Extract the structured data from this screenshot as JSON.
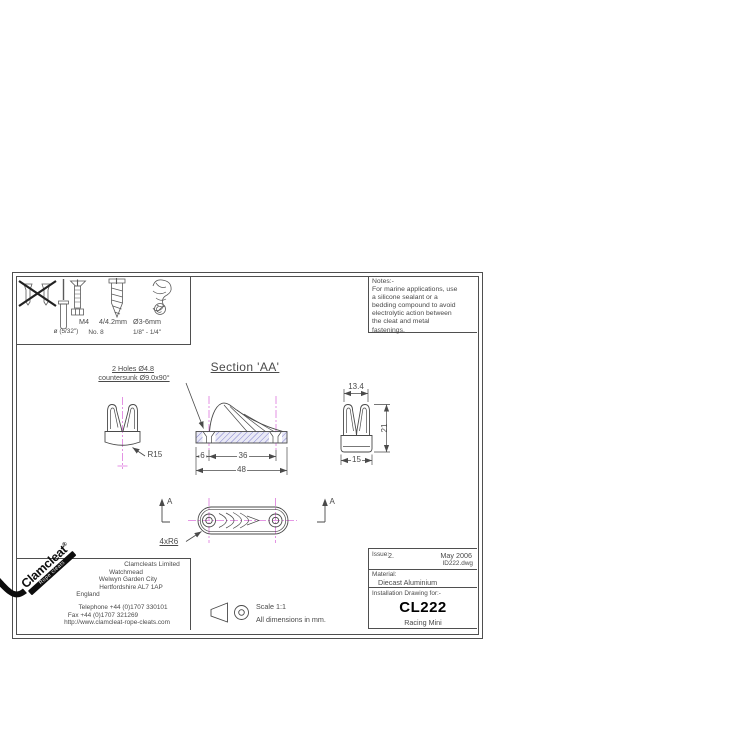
{
  "colors": {
    "line": "#4a4a4a",
    "centerline": "#dd77dd",
    "hatch_line": "#8080cc",
    "hatch_bg": "#e9e9f6",
    "logo_black": "#0d0d0d"
  },
  "sheet": {
    "fasteners": {
      "row1": {
        "m4": "M4",
        "wood_metric": "4/4.2mm",
        "rope_metric": "Ø3-6mm"
      },
      "row2": {
        "rivet_size": "ø (5/32\")",
        "wood_gauge": "No. 8",
        "rope_imperial": "1/8\" - 1/4\""
      }
    },
    "notes": {
      "title": "Notes:-",
      "lines": [
        "For marine applications, use",
        "a silicone sealant or a",
        "bedding compound to avoid",
        "electrolytic action between",
        "the cleat and metal",
        "fastenings."
      ]
    },
    "annotations": {
      "holes_line1": "2 Holes Ø4.8",
      "holes_line2": "countersunk Ø9.0x90°",
      "section_title": "Section 'AA'",
      "radius": "R15",
      "dim_6": "6",
      "dim_36": "36",
      "dim_48": "48",
      "dim_13_4": "13.4",
      "dim_21": "21",
      "dim_15": "15",
      "ribs": "4xR6",
      "section_letter": "A"
    }
  },
  "company": {
    "logo_name": "Clamcleat",
    "logo_reg": "®",
    "logo_tag": "Rope cleats",
    "name": "Clamcleats Limited",
    "address": [
      "Watchmead",
      "Welwyn Garden City",
      "Hertfordshire AL7 1AP",
      "England"
    ],
    "telephone": "Telephone +44 (0)1707 330101",
    "fax": "Fax +44 (0)1707 321269",
    "url": "http://www.clamcleat-rope-cleats.com"
  },
  "scale_block": {
    "scale": "Scale 1:1",
    "units": "All dimensions in mm."
  },
  "title_block": {
    "issue_label": "Issue:",
    "issue_value": "2.",
    "date": "May 2006",
    "file": "ID222.dwg",
    "material_label": "Material:",
    "material": "Diecast Aluminium",
    "drawing_for": "Installation Drawing for:-",
    "product_code": "CL222",
    "product_name": "Racing Mini"
  }
}
